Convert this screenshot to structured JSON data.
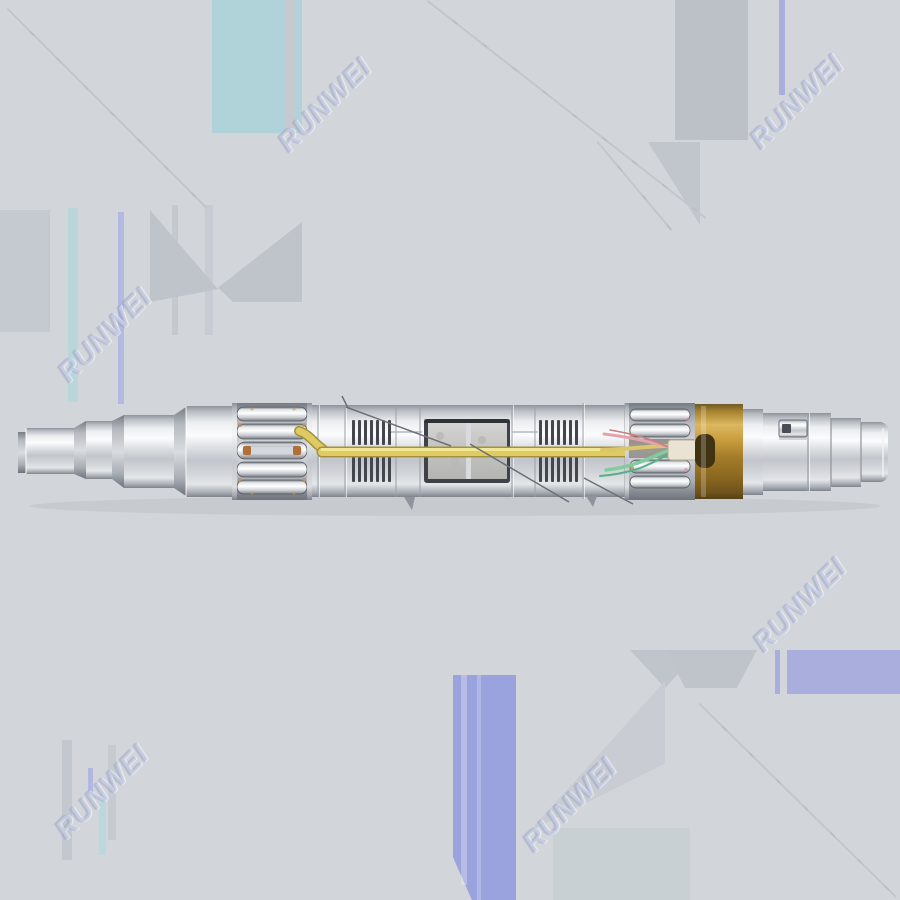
{
  "image": {
    "type": "product-photo",
    "subject": "stainless-steel cylindrical probe module shown horizontally: stepped nose cone, slotted cage windows, vertical vent slots, frosted viewport blocks, internal yellow optical fiber, colored wires, brass band and keyed tail connector",
    "background_color": "#d2d5da",
    "colors": {
      "metal_silver": "#d8dbdf",
      "brass_band": "#b68a33",
      "fiber_yellow": "#e6d46e",
      "wire_green": "#7fcc9c",
      "wire_pink": "#e3a3ad",
      "lavender_patch": "#9aa3dd",
      "teal_patch": "#b0d3da"
    }
  },
  "watermark": {
    "text": "RUNWEI",
    "count": 6,
    "color": "#b6c0dc",
    "rotation_deg": -45
  }
}
